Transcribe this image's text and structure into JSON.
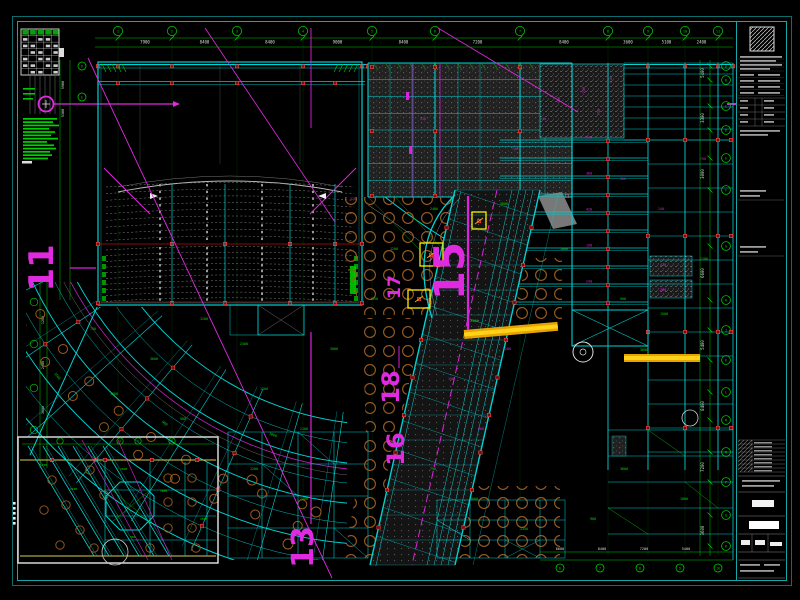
{
  "sheet_type": "structural-framing-plan",
  "colors": {
    "background": "#000000",
    "border_teal": "#12a0a0",
    "beam_cyan": "#00d2d2",
    "grid_green": "#00c800",
    "section_magenta": "#e02ae0",
    "node_red": "#ff4040",
    "highlight_yellow": "#ffd21a",
    "highlight_orange": "#e6a400",
    "hole_orange": "#9a5b20",
    "dim_white": "#dddddd"
  },
  "section_markers": [
    {
      "label": "11"
    },
    {
      "label": "13"
    },
    {
      "label": "15"
    },
    {
      "label": "17"
    },
    {
      "label": "18"
    },
    {
      "label": "16"
    }
  ],
  "grid_bubbles": {
    "top": [
      "1",
      "2",
      "3",
      "4",
      "5",
      "6",
      "7",
      "8",
      "9",
      "10",
      "11"
    ],
    "right": [
      "A",
      "B",
      "C",
      "D",
      "E",
      "F",
      "G",
      "H",
      "J",
      "K",
      "L",
      "M",
      "N",
      "P",
      "Q",
      "R"
    ],
    "left": [
      "D",
      "E"
    ],
    "bottom": [
      "6",
      "7",
      "8",
      "9",
      "10"
    ],
    "inset_top": [
      "4",
      "5",
      "6"
    ]
  },
  "dimensions": {
    "top": [
      "7900",
      "8400",
      "8400",
      "9000",
      "8400",
      "7200",
      "8400",
      "3600",
      "5100",
      "2400"
    ],
    "right": [
      "5400",
      "3300",
      "3000",
      "6600",
      "5400",
      "8400",
      "7200",
      "3600"
    ],
    "left": [
      "5900",
      "5300"
    ],
    "bottom": [
      "6600",
      "8400",
      "7200",
      "5400"
    ],
    "green_pool": [
      "1200",
      "2400",
      "3600",
      "1800",
      "900",
      "1500",
      "2100",
      "750",
      "3000",
      "1350"
    ],
    "magenta_pool": [
      "240",
      "750",
      "360",
      "510",
      "420",
      "280",
      "198",
      "660"
    ]
  }
}
